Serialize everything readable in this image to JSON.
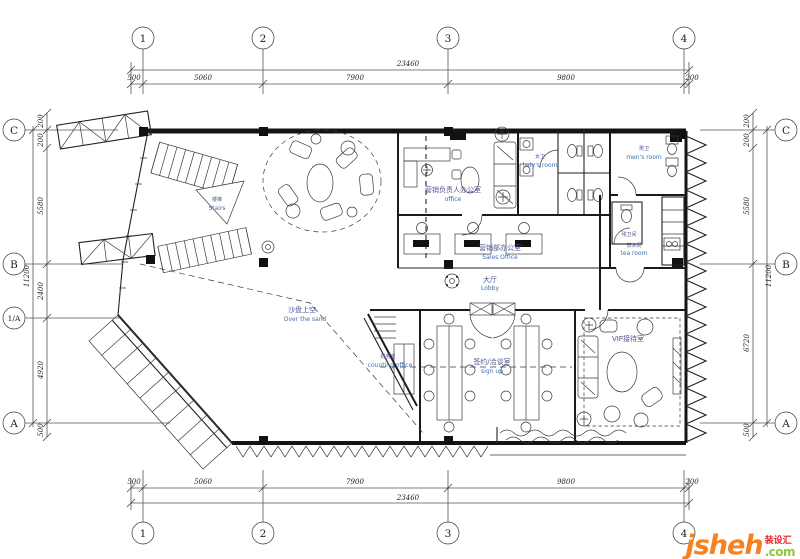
{
  "title": "首层平面布置图",
  "colors": {
    "line": "#1a1a1a",
    "label_zh": "#4f5490",
    "label_en": "#3f6fae",
    "logo_orange": "#f5821f",
    "logo_green": "#8dc63f",
    "logo_red": "#e8262d"
  },
  "grid_bubbles": {
    "top": [
      "1",
      "2",
      "3",
      "4"
    ],
    "bottom": [
      "1",
      "2",
      "3",
      "4"
    ],
    "left": [
      "C",
      "B",
      "1/A",
      "A"
    ],
    "right": [
      "C",
      "B",
      "A"
    ]
  },
  "dimensions": {
    "top": {
      "total": "23460",
      "segments": [
        "500",
        "5060",
        "7900",
        "9800",
        "200"
      ]
    },
    "bottom": {
      "total": "23460",
      "segments": [
        "500",
        "5060",
        "7900",
        "9800",
        "200"
      ]
    },
    "left": {
      "total": "11200",
      "segments": [
        "200",
        "200",
        "5580",
        "2400",
        "4920",
        "500"
      ]
    },
    "right": {
      "total": "11200",
      "segments": [
        "200",
        "200",
        "5580",
        "6720",
        "500"
      ]
    }
  },
  "rooms": {
    "stairs": {
      "zh": "楼梯",
      "en": "Stairs"
    },
    "director_office": {
      "zh": "营销负责人办公室",
      "en": "office"
    },
    "sales_office": {
      "zh": "营销部办公室",
      "en": "Sales Office"
    },
    "ladies_room": {
      "zh": "女卫",
      "en": "lady's room"
    },
    "mens_room": {
      "zh": "男卫",
      "en": "men's room"
    },
    "acc_wc": {
      "zh": "残卫间",
      "en": ""
    },
    "tea_room": {
      "zh": "茶水间",
      "en": "tea room"
    },
    "lobby": {
      "zh": "大厅",
      "en": "Lobby"
    },
    "sand_void": {
      "zh": "沙盘上空",
      "en": "Over the sand"
    },
    "finance": {
      "zh": "财务室",
      "en": "counting office"
    },
    "sign_room": {
      "zh": "签约/洽谈室",
      "en": "sign up"
    },
    "vip": {
      "zh": "VIP接待室",
      "en": ""
    }
  },
  "logo": {
    "brand": "jsheh",
    "tld": ".com",
    "tag": "装设汇"
  }
}
